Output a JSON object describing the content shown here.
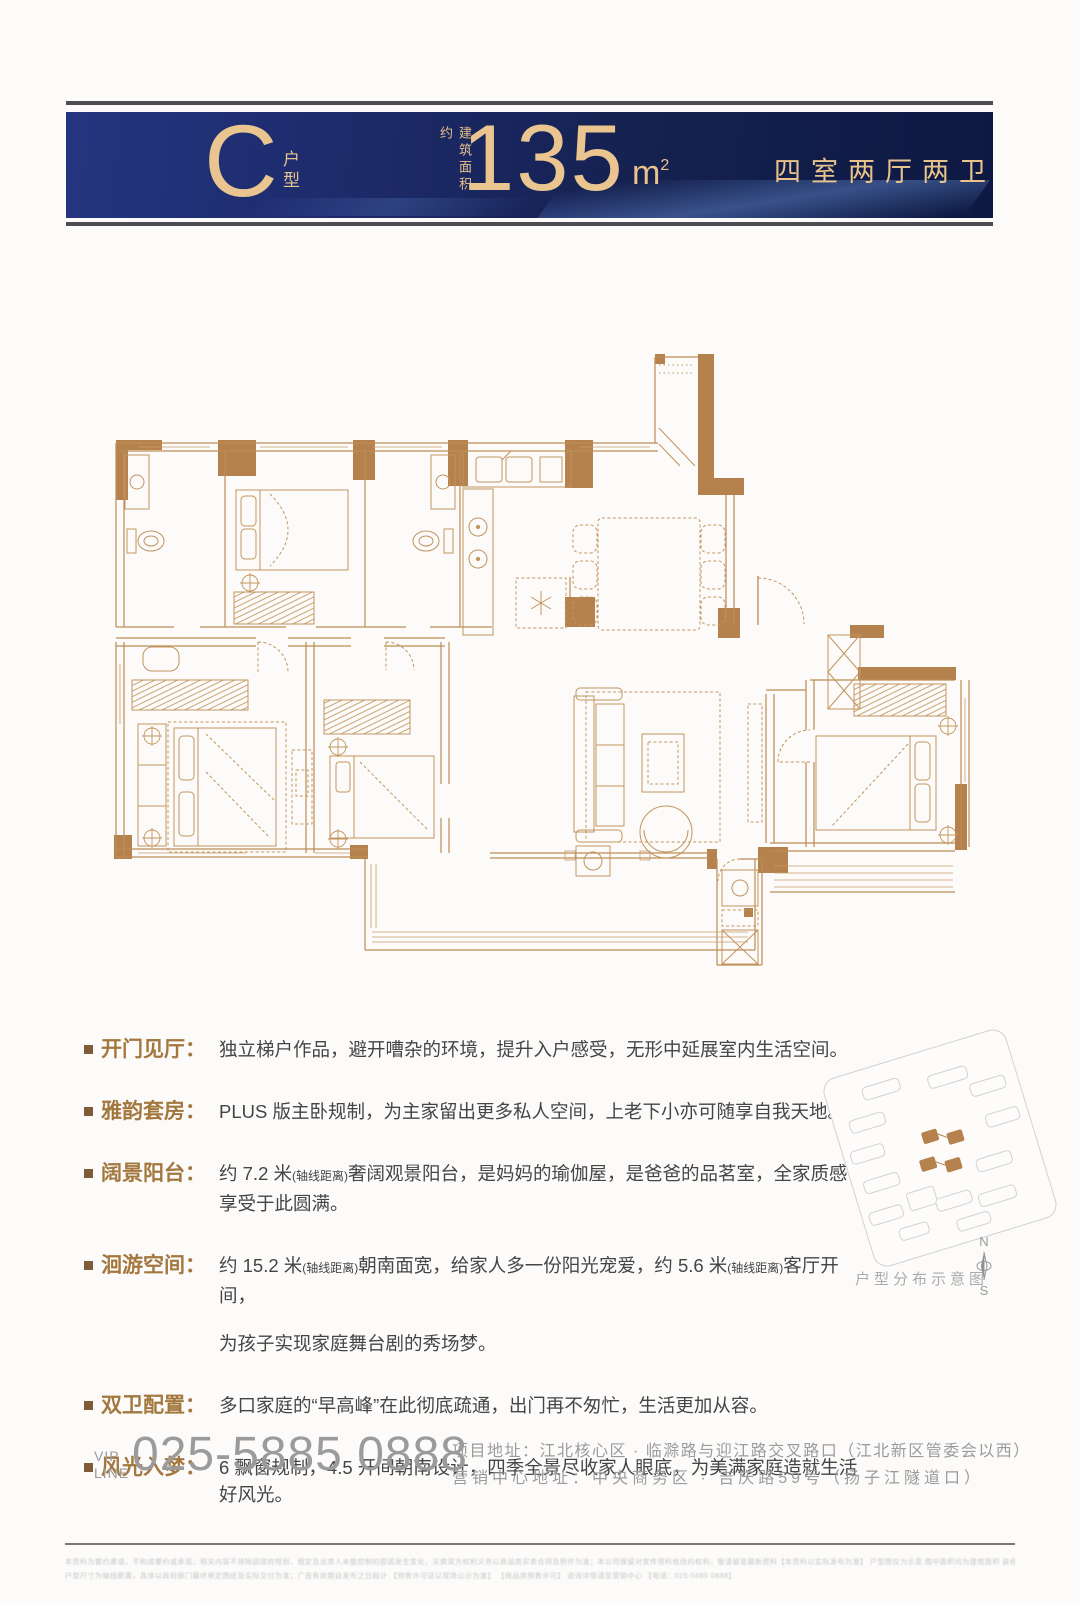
{
  "header": {
    "unit_letter": "C",
    "unit_label_char1": "户",
    "unit_label_char2": "型",
    "area_prefix": "建筑面积约",
    "area_value": "135",
    "area_unit": "m",
    "area_unit_sup": "2",
    "layout_label": "四室两厅两卫"
  },
  "features": {
    "colon": "：",
    "items": [
      {
        "label": "开门见厅",
        "segments": [
          {
            "t": "独立梯户作品，避开嘈杂的环境，提升入户感受，无形中延展室内生活空间。",
            "sm": false
          }
        ]
      },
      {
        "label": "雅韵套房",
        "segments": [
          {
            "t": "PLUS 版主卧规制，为主家留出更多私人空间，上老下小亦可随享自我天地。",
            "sm": false
          }
        ]
      },
      {
        "label": "阔景阳台",
        "segments": [
          {
            "t": "约 7.2 米",
            "sm": false
          },
          {
            "t": "(轴线距离)",
            "sm": true
          },
          {
            "t": "奢阔观景阳台，是妈妈的瑜伽屋，是爸爸的品茗室，全家质感享受于此圆满。",
            "sm": false
          }
        ]
      },
      {
        "label": "洄游空间",
        "segments": [
          {
            "t": "约 15.2 米",
            "sm": false
          },
          {
            "t": "(轴线距离)",
            "sm": true
          },
          {
            "t": "朝南面宽，给家人多一份阳光宠爱，约 5.6 米",
            "sm": false
          },
          {
            "t": "(轴线距离)",
            "sm": true
          },
          {
            "t": "客厅开间，",
            "sm": false
          }
        ],
        "line2": "为孩子实现家庭舞台剧的秀场梦。"
      },
      {
        "label": "双卫配置",
        "segments": [
          {
            "t": "多口家庭的“早高峰”在此彻底疏通，出门再不匆忙，生活更加从容。",
            "sm": false
          }
        ]
      },
      {
        "label": "风光入梦",
        "segments": [
          {
            "t": "6 飘窗规制，4.5 开间朝南设计，四季全景尽收家人眼底，为美满家庭造就生活好风光。",
            "sm": false
          }
        ]
      }
    ]
  },
  "sitemap": {
    "caption": "户型分布示意图",
    "compass_n": "N",
    "compass_s": "S"
  },
  "footer": {
    "vip_line1": "VIP",
    "vip_line2": "LINE",
    "phone": "025-5885 0888",
    "address1": "项目地址：江北核心区 ·  临滁路与迎江路交叉路口（江北新区管委会以西）",
    "address2": "营销中心地址：中央商务区 · 吉庆路59号（扬子江隧道口）",
    "disclaimer1": "本资料为要约邀请，不构成要约或承诺；相关内容不排除因政府规划、规定及出卖人未能控制的原因发生变化，买卖双方权利义务以商品房买卖合同及附件为准；本公司保留对宣传资料修改的权利，敬请留意最新资料【本资料以实际发布为准】 户型图仅为示意 图中面积均为建筑面积 装修、家具、家电仅为示意 不作为交付标准",
    "disclaimer2": "户型尺寸为轴线距离，具体以政府部门最终审定图纸及实际交付为准；广告有效期自发布之日起计 【预售许可证以现场公示为准】 【商品房预售许可】 咨询详情请至营销中心 【电话：025-5885 0888】"
  },
  "colors": {
    "banner_blue_left": "#24357f",
    "banner_blue_right": "#0d1942",
    "gold_text": "#eac58f",
    "wall_gold": "#b5824e",
    "feature_label_brown": "#a2783e",
    "bullet_brown": "#7f5c35",
    "body_text": "#454545",
    "footer_gray": "#9b9b9b"
  }
}
